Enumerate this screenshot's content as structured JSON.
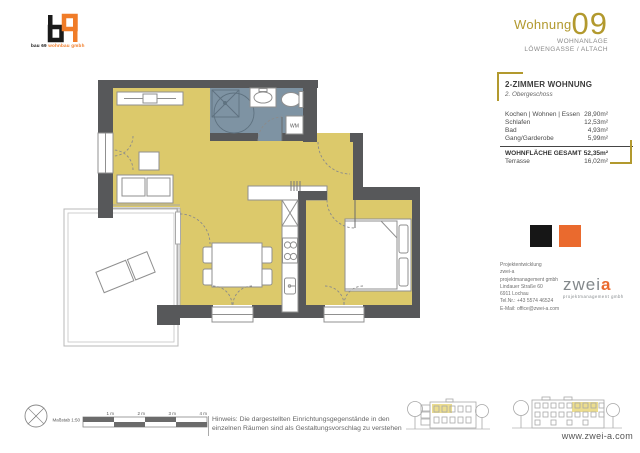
{
  "logo": {
    "tagline_left": "bau 69 ",
    "tagline_right": "wohnbau gmbh"
  },
  "header": {
    "apartment_label": "Wohnung",
    "apartment_number": "09",
    "project_line1": "WOHNANLAGE",
    "project_line2": "LÖWENGASSE / ALTACH"
  },
  "info_panel": {
    "title": "2-ZIMMER WOHNUNG",
    "subtitle": "2. Obergeschoss",
    "rooms": [
      {
        "label": "Kochen | Wohnen | Essen",
        "area": "28,90m²"
      },
      {
        "label": "Schlafen",
        "area": "12,53m²"
      },
      {
        "label": "Bad",
        "area": "4,93m²"
      },
      {
        "label": "Gang/Garderobe",
        "area": "5,99m²"
      }
    ],
    "total_label": "WOHNFLÄCHE GESAMT",
    "total_area": "52,35m²",
    "extra_label": "Terrasse",
    "extra_area": "16,02m²"
  },
  "contact": {
    "heading": "Projektentwicklung",
    "lines": [
      "zwei-a",
      "projektmanagement gmbh",
      "Lindauer Straße 60",
      "6911 Lochau",
      "Tel.Nr.: +43 5574 46524",
      "E-Mail: office@zwei-a.com"
    ]
  },
  "brand": {
    "logo_text": "zwei",
    "logo_accent": "a",
    "logo_sub": "projektmanagement gmbh",
    "website": "www.zwei-a.com"
  },
  "plan": {
    "wm_label": "WM"
  },
  "footer": {
    "scale_label": "Maßstab 1:50",
    "scale_ticks": [
      "1 m",
      "2 m",
      "3 m",
      "4 m"
    ],
    "note_line1": "Hinweis: Die dargestellten Einrichtungsgegenstände in den",
    "note_line2": "einzelnen Räumen sind als Gestaltungsvorschlag zu verstehen"
  },
  "colors": {
    "accent_gold": "#b2992e",
    "accent_orange": "#ea6a2e",
    "room_fill": "#dcc96b",
    "bath_fill": "#7e93a3",
    "wall": "#57585a"
  }
}
